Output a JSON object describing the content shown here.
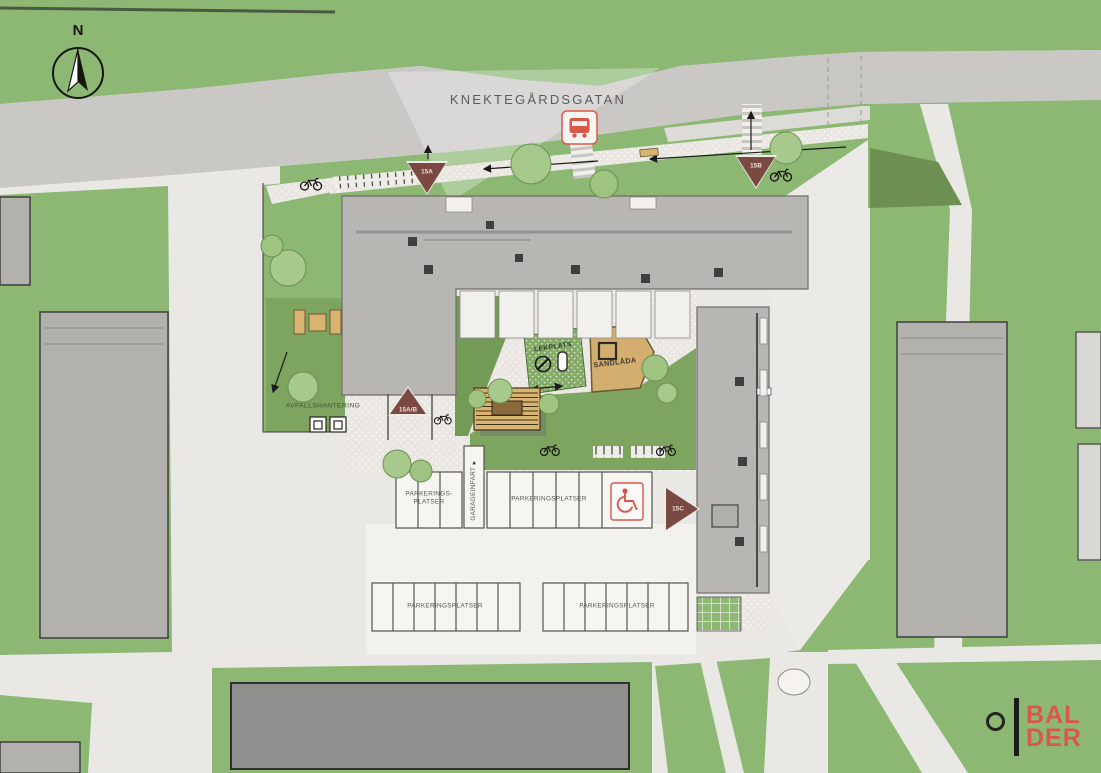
{
  "colors": {
    "grass": "#8cb873",
    "grass_dark": "#6d8f52",
    "courtyard": "#7da55f",
    "road": "#c9c8c5",
    "ground": "#e9e8e5",
    "paving": "#f2f1ee",
    "building": "#b7b6b3",
    "building_line": "#6f6e6b",
    "neighbor": "#b2b1ae",
    "dark_building": "#8f8f8d",
    "sand": "#d3ae6e",
    "wood": "#d9b470",
    "marker": "#7a4a42",
    "accent": "#d9584a",
    "logo_red": "#d95848",
    "label": "#4a4a44",
    "street_label": "#5c5c5a"
  },
  "street": {
    "name": "KNEKTEGÅRDSGATAN"
  },
  "compass": {
    "north_label": "N"
  },
  "entrances": {
    "a_label": "15A",
    "b_label": "15B",
    "ab_label": "15A/B",
    "c_label": "15C"
  },
  "courtyard": {
    "playground_label": "LEKPLATS",
    "sandbox_label": "SANDLÅDA"
  },
  "waste": {
    "label": "AVFALLSHANTERING"
  },
  "parking": {
    "left_block_label": "PARKERINGS-\nPLATSER",
    "garage_entry_label": "GARAGEINFART",
    "middle_block_label": "PARKERINGSPLATSER",
    "bottom_left_block_label": "PARKERINGSPLATSER",
    "bottom_right_block_label": "PARKERINGSPLATSER"
  },
  "logo": {
    "line1": "BAL",
    "line2": "DER"
  },
  "icons": [
    "north-arrow",
    "bus-stop",
    "pedestrian-crossing",
    "bicycle",
    "bicycle-rack",
    "bench",
    "playground-spinner",
    "playground-spring-rider",
    "sandbox",
    "pergola",
    "waste-bins",
    "accessible-parking",
    "tree",
    "pond",
    "entrance-marker",
    "logo-ring"
  ]
}
